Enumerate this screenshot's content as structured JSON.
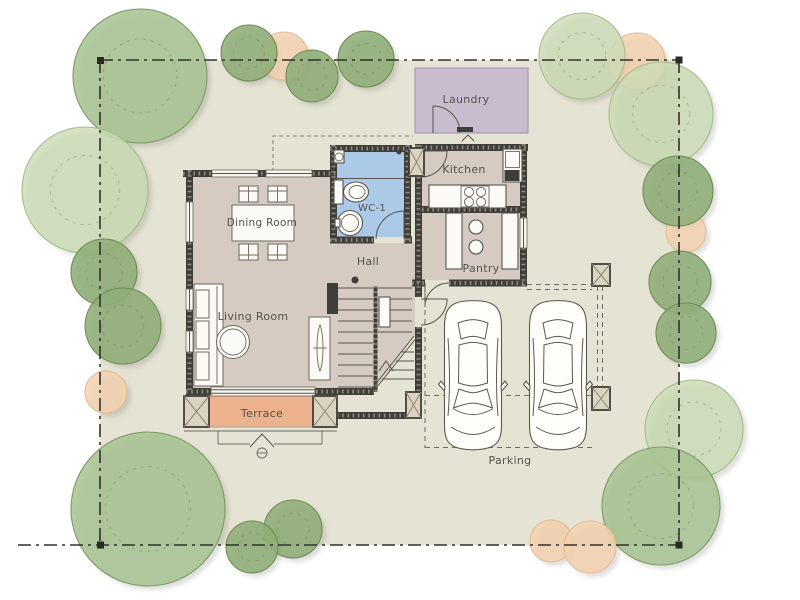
{
  "meta": {
    "type": "architectural-site-plan",
    "view": "ground-floor with garden and parking"
  },
  "colors": {
    "page": "#ffffff",
    "site": "#e5e3d3",
    "floor": "#d5cbc3",
    "laundry_fill": "#c9bcce",
    "wc_fill": "#abcae7",
    "terrace_fill": "#ecb28d",
    "wall": "#403e39",
    "boundary_line": "#32312b",
    "label_text": "#55524b",
    "tree_mid": "#a7c391",
    "tree_dark": "#8fae77",
    "tree_pale": "#cadcb5",
    "shrub_peach": "#f4d2b0"
  },
  "rooms": {
    "laundry": {
      "label": "Laundry"
    },
    "kitchen": {
      "label": "Kitchen"
    },
    "wc1": {
      "label": "WC-1"
    },
    "dining": {
      "label": "Dining Room"
    },
    "hall": {
      "label": "Hall"
    },
    "pantry": {
      "label": "Pantry"
    },
    "living": {
      "label": "Living Room"
    },
    "terrace": {
      "label": "Terrace"
    },
    "parking": {
      "label": "Parking"
    }
  },
  "site": {
    "boundary_style": "dash-dot property line with corner markers",
    "cars_parked": 2
  },
  "trees": [
    {
      "x": 140,
      "y": 76,
      "r": 67,
      "kind": "mid"
    },
    {
      "x": 85,
      "y": 190,
      "r": 63,
      "kind": "pale"
    },
    {
      "x": 104,
      "y": 272,
      "r": 33,
      "kind": "dark"
    },
    {
      "x": 123,
      "y": 326,
      "r": 38,
      "kind": "dark"
    },
    {
      "x": 106,
      "y": 392,
      "r": 21,
      "kind": "peach"
    },
    {
      "x": 148,
      "y": 509,
      "r": 77,
      "kind": "mid"
    },
    {
      "x": 293,
      "y": 529,
      "r": 29,
      "kind": "dark"
    },
    {
      "x": 252,
      "y": 547,
      "r": 26,
      "kind": "dark"
    },
    {
      "x": 284,
      "y": 56,
      "r": 24,
      "kind": "peach"
    },
    {
      "x": 249,
      "y": 53,
      "r": 28,
      "kind": "dark"
    },
    {
      "x": 312,
      "y": 76,
      "r": 26,
      "kind": "dark"
    },
    {
      "x": 366,
      "y": 59,
      "r": 28,
      "kind": "dark"
    },
    {
      "x": 637,
      "y": 61,
      "r": 28,
      "kind": "peach"
    },
    {
      "x": 582,
      "y": 56,
      "r": 43,
      "kind": "pale"
    },
    {
      "x": 661,
      "y": 114,
      "r": 52,
      "kind": "pale"
    },
    {
      "x": 686,
      "y": 232,
      "r": 20,
      "kind": "peach"
    },
    {
      "x": 678,
      "y": 191,
      "r": 35,
      "kind": "dark"
    },
    {
      "x": 680,
      "y": 282,
      "r": 31,
      "kind": "dark"
    },
    {
      "x": 686,
      "y": 333,
      "r": 30,
      "kind": "dark"
    },
    {
      "x": 694,
      "y": 429,
      "r": 49,
      "kind": "pale"
    },
    {
      "x": 661,
      "y": 506,
      "r": 59,
      "kind": "mid"
    },
    {
      "x": 551,
      "y": 541,
      "r": 21,
      "kind": "peach"
    },
    {
      "x": 590,
      "y": 547,
      "r": 26,
      "kind": "peach"
    }
  ]
}
